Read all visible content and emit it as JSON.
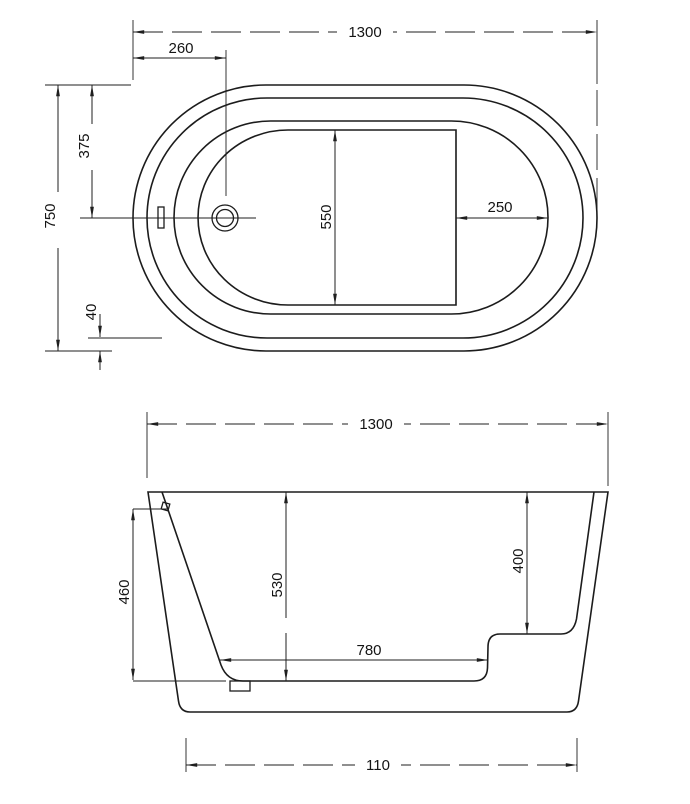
{
  "drawing": {
    "plan_view": {
      "overall_length": "1300",
      "drain_center_from_end": "260",
      "overall_width": "750",
      "center_from_edge": "375",
      "rim_width": "40",
      "floor_width": "550",
      "seat_to_end": "250"
    },
    "side_view": {
      "overall_length": "1300",
      "depth_to_overflow": "460",
      "overall_height": "530",
      "rim_to_seat": "400",
      "floor_length": "780",
      "base_length": "110"
    }
  }
}
